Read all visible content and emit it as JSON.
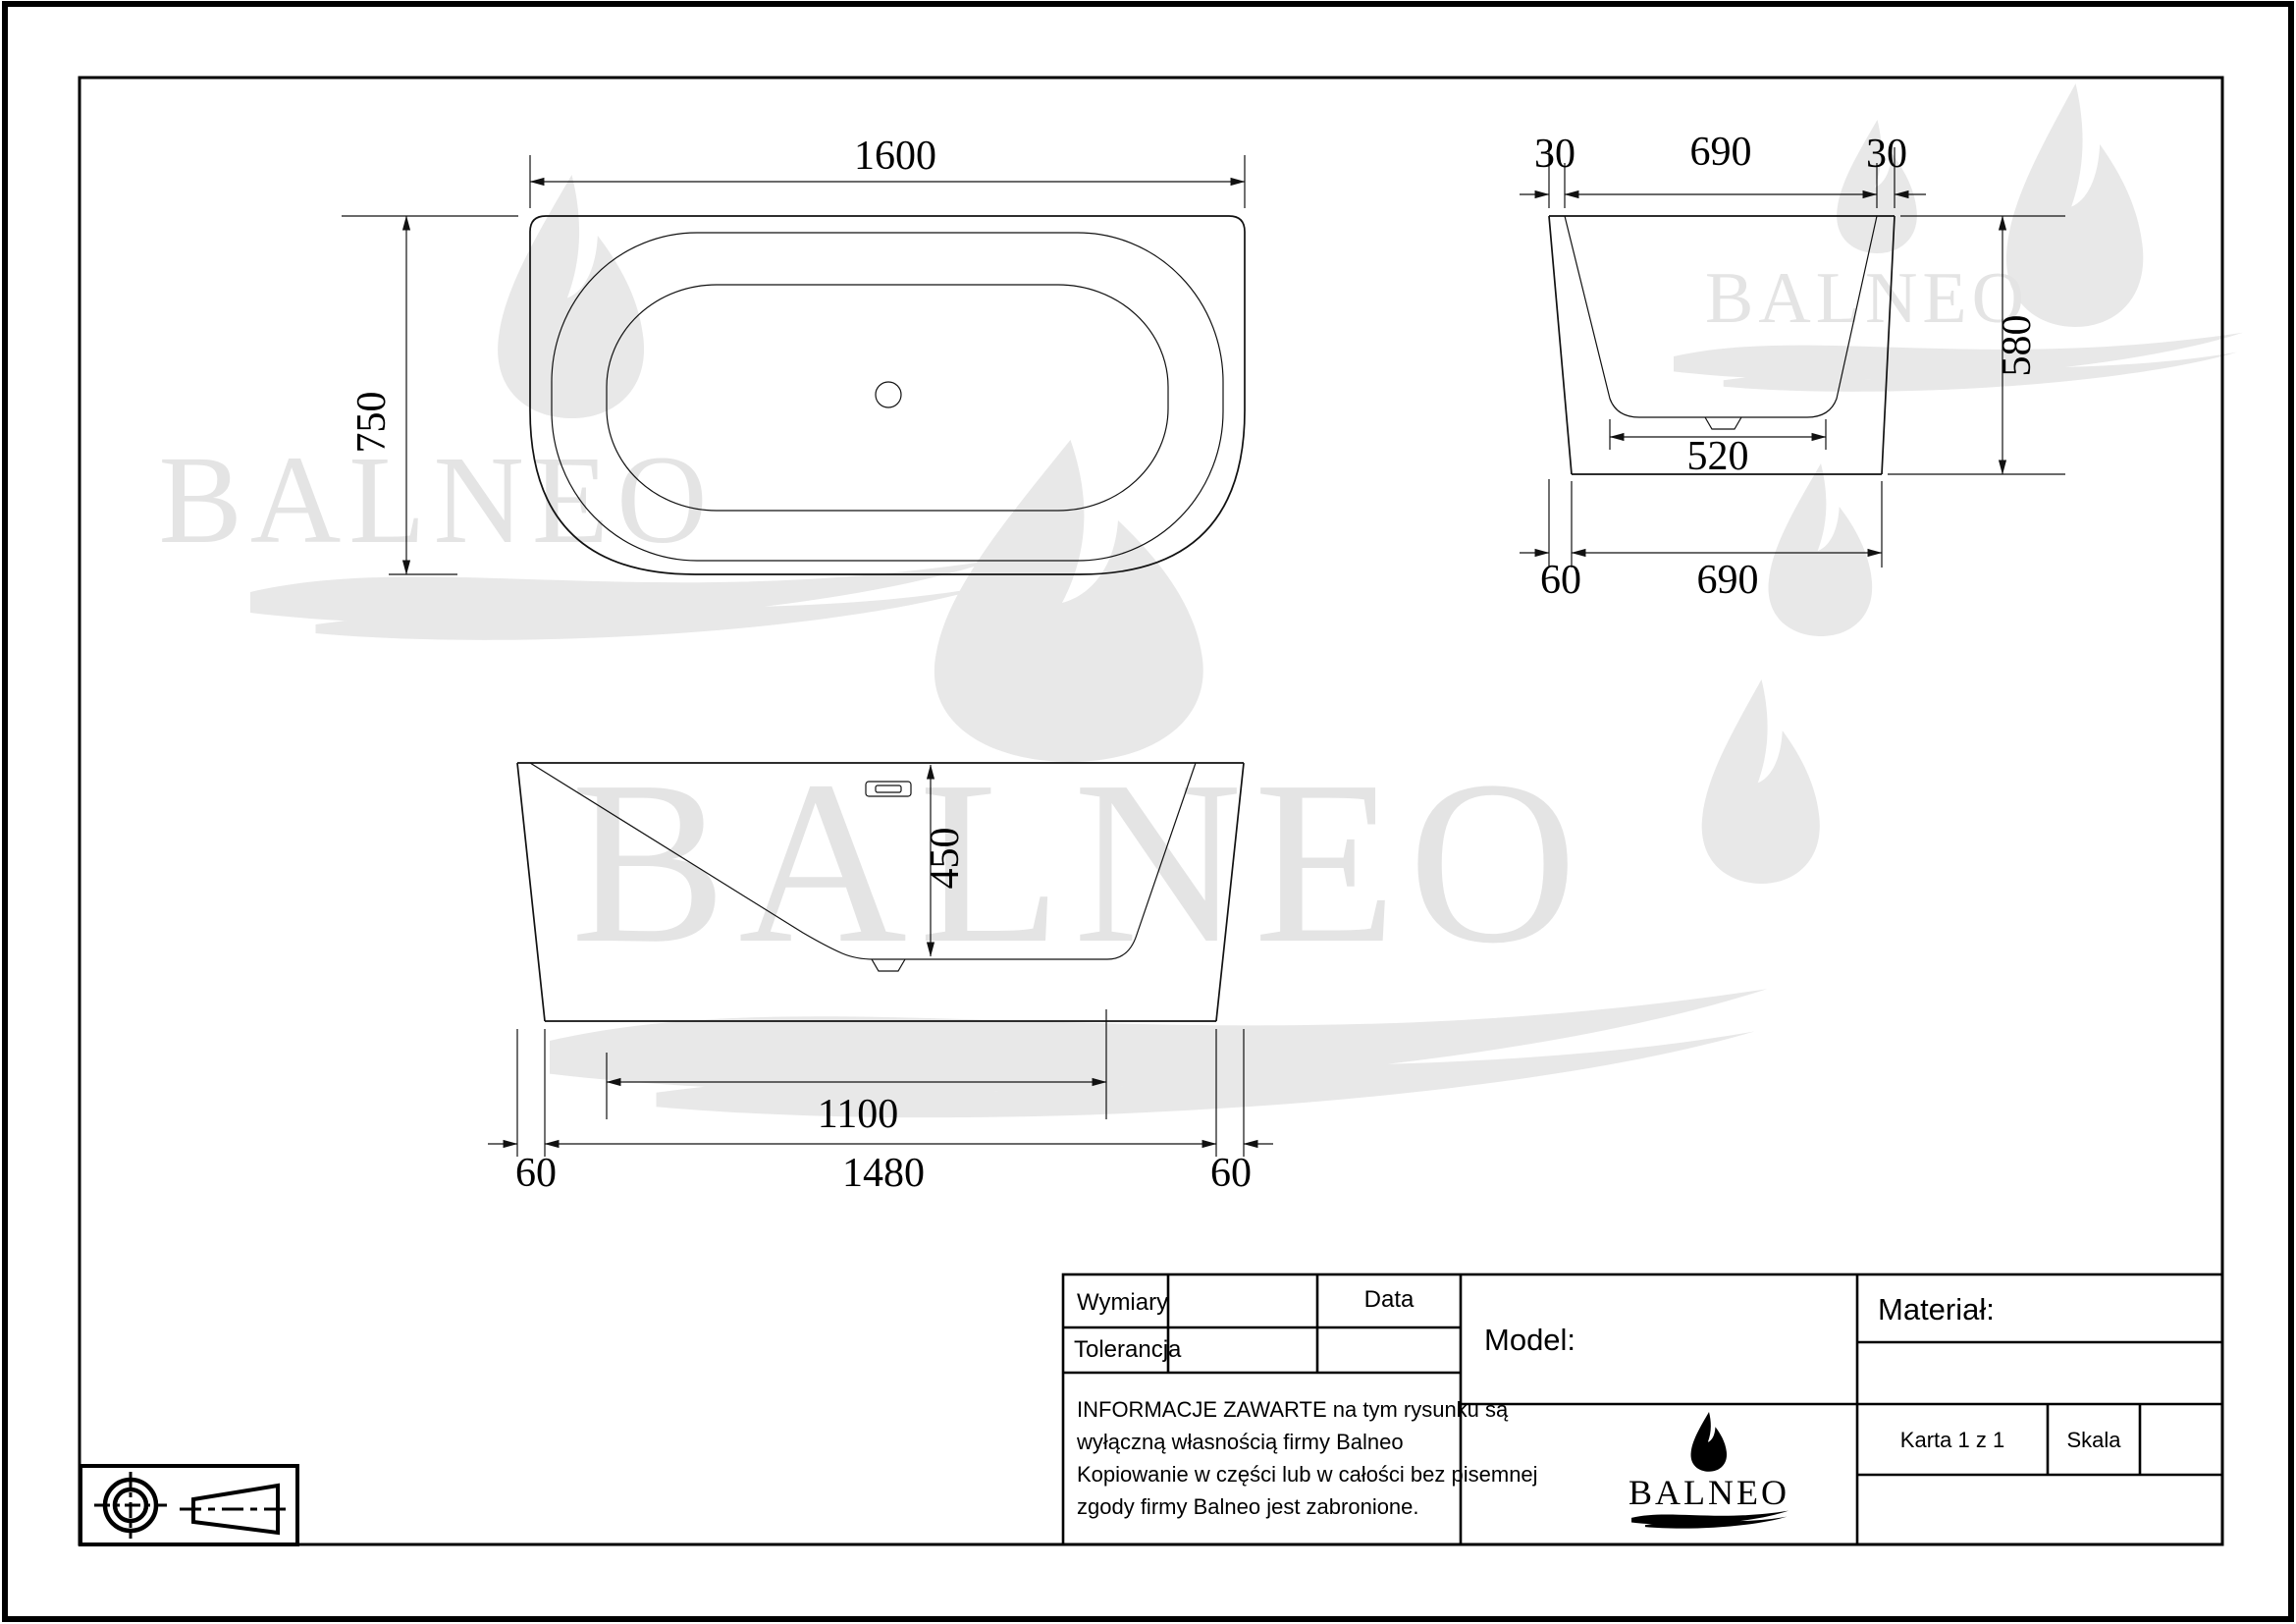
{
  "dimensions": {
    "plan": {
      "width": "1600",
      "depth": "750"
    },
    "side": {
      "offset_left": "30",
      "top_width": "690",
      "offset_right": "30",
      "height": "580",
      "floor_width": "520",
      "base_offset": "60",
      "base_width": "690"
    },
    "front": {
      "inner_depth": "450",
      "floor_length": "1100",
      "base_width": "1480",
      "offset_left": "60",
      "offset_right": "60"
    }
  },
  "title_block": {
    "wymiary_label": "Wymiary",
    "tolerancja_label": "Tolerancja",
    "data_label": "Data",
    "model_label": "Model:",
    "material_label": "Materiał:",
    "karta_label": "Karta 1 z 1",
    "skala_label": "Skala",
    "info_lines": [
      "INFORMACJE ZAWARTE na tym rysunku są",
      "wyłączną własnością firmy Balneo",
      "Kopiowanie w części lub w całości bez pisemnej",
      "zgody firmy Balneo jest zabronione."
    ],
    "logo_text": "BALNEO"
  },
  "watermark": {
    "text": "BALNEO",
    "color": "#e8e8e8"
  },
  "colors": {
    "line": "#111111",
    "background": "#ffffff"
  }
}
